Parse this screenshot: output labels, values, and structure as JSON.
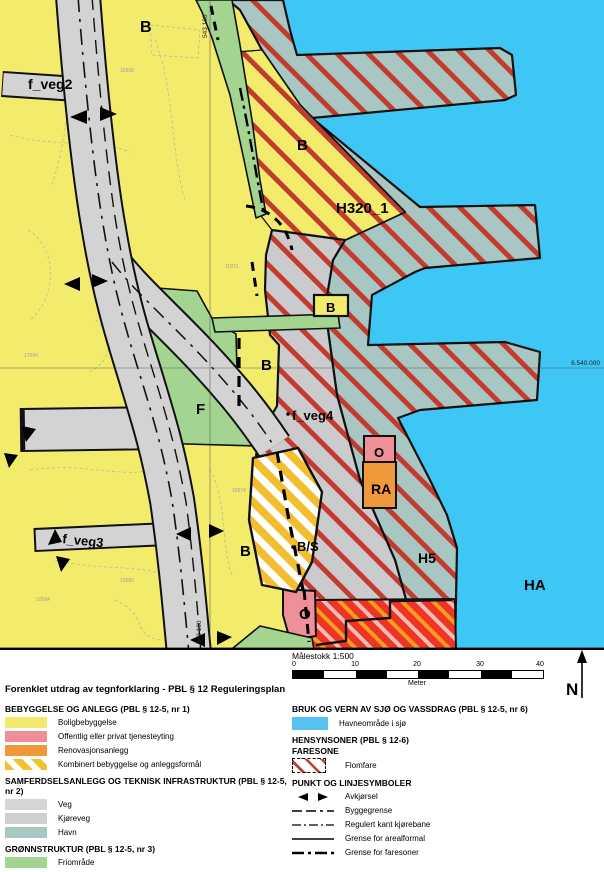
{
  "map": {
    "area_labels": [
      {
        "text": "B"
      },
      {
        "text": "f_veg2"
      },
      {
        "text": "B"
      },
      {
        "text": "H320_1"
      },
      {
        "text": "B"
      },
      {
        "text": "B"
      },
      {
        "text": "F"
      },
      {
        "text": "f_veg4"
      },
      {
        "text": "O"
      },
      {
        "text": "RA"
      },
      {
        "text": "f_veg3"
      },
      {
        "text": "B"
      },
      {
        "text": "B/S"
      },
      {
        "text": "H5"
      },
      {
        "text": "HA"
      },
      {
        "text": "O"
      }
    ],
    "coordinate_labels": [
      {
        "text": "543 100"
      },
      {
        "text": "6.540.000"
      },
      {
        "text": "543 100"
      }
    ],
    "parcel_labels": [
      {
        "text": "10958"
      },
      {
        "text": "11871"
      },
      {
        "text": "17094"
      },
      {
        "text": "10974"
      },
      {
        "text": "13580"
      },
      {
        "text": "10584"
      }
    ],
    "colors": {
      "sea": "#3EC7F4",
      "residential_yellow": "#F2EB6C",
      "harbour_teal": "#A9C7C2",
      "road_gray": "#D3D3D4",
      "green_area": "#A3D591",
      "flood_hatch_red": "#C33B2F",
      "red_zone": "#EE3425",
      "pink_zone": "#EF9098",
      "orange_zone": "#F0983C"
    }
  },
  "scale": {
    "title": "Målestokk 1:500",
    "ticks": [
      "0",
      "10",
      "20",
      "30",
      "40"
    ],
    "unit": "Meter"
  },
  "north": {
    "label": "N"
  },
  "legend": {
    "title": "Forenklet utdrag av tegnforklaring - PBL § 12 Reguleringsplan",
    "sections": [
      {
        "heading": "BEBYGGELSE OG ANLEGG (PBL § 12-5, nr 1)",
        "items": [
          {
            "label": "Boligbebyggelse",
            "color": "#F2E96D"
          },
          {
            "label": "Offentlig eller privat tjenesteyting",
            "color": "#EE8E96"
          },
          {
            "label": "Renovasjonsanlegg",
            "color": "#F0983C"
          },
          {
            "label": "Kombinert bebyggelse og anleggsformål",
            "color": "#F2C22E"
          }
        ]
      },
      {
        "heading": "SAMFERDSELSANLEGG OG TEKNISK INFRASTRUKTUR (PBL § 12-5, nr 2)",
        "items": [
          {
            "label": "Veg",
            "color": "#D5D5D5"
          },
          {
            "label": "Kjøreveg",
            "color": "#CFCFD0"
          },
          {
            "label": "Havn",
            "color": "#A9C7C2"
          }
        ]
      },
      {
        "heading": "GRØNNSTRUKTUR (PBL § 12-5, nr 3)",
        "items": [
          {
            "label": "Friområde",
            "color": "#A3D591"
          }
        ]
      },
      {
        "heading": "BRUK OG VERN AV SJØ OG VASSDRAG (PBL § 12-5, nr 6)",
        "items": [
          {
            "label": "Havneområde i sjø",
            "color": "#55C3F0"
          }
        ]
      },
      {
        "heading": "HENSYNSONER (PBL § 12-6)",
        "subheading": "FARESONE",
        "items": [
          {
            "label": "Flomfare",
            "color": "#C33B2F"
          }
        ]
      },
      {
        "heading": "PUNKT OG LINJESYMBOLER",
        "items": [
          {
            "label": "Avkjørsel"
          },
          {
            "label": "Byggegrense"
          },
          {
            "label": "Regulert kant kjørebane"
          },
          {
            "label": "Grense for arealformal"
          },
          {
            "label": "Grense for faresoner"
          }
        ]
      }
    ]
  }
}
